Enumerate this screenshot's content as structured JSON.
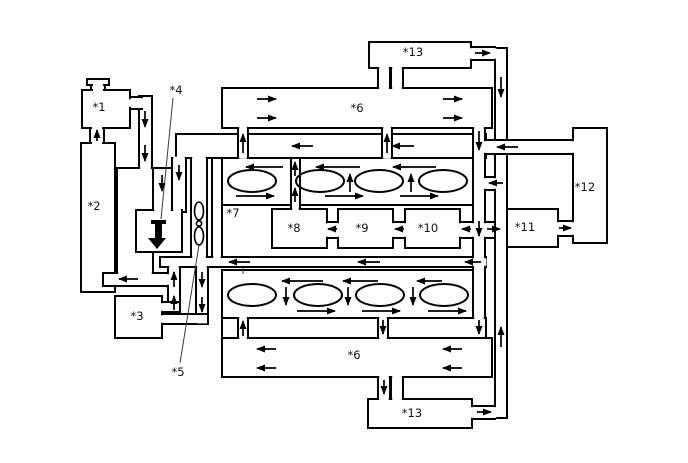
{
  "diagram": {
    "type": "engine-coolant-flow-schematic",
    "background_color": "#ffffff",
    "line_color": "#000000",
    "labels": {
      "c1": "*1",
      "c2": "*2",
      "c3": "*3",
      "c4": "*4",
      "c5": "*5",
      "c6": "*6",
      "c7": "*7",
      "c8": "*8",
      "c9": "*9",
      "c10": "*10",
      "c11": "*11",
      "c12": "*12",
      "c13": "*13"
    },
    "icons": {
      "thermostat": "thick-down-arrow-icon",
      "pump": "impeller-icon",
      "cap": "filler-cap-icon"
    },
    "flow_arrows": [
      [
        97,
        141,
        97,
        130
      ],
      [
        145,
        111,
        145,
        127
      ],
      [
        145,
        145,
        145,
        161
      ],
      [
        162,
        175,
        162,
        191
      ],
      [
        179,
        165,
        179,
        180
      ],
      [
        138,
        279,
        119,
        279
      ],
      [
        174,
        287,
        174,
        272
      ],
      [
        174,
        310,
        174,
        296
      ],
      [
        202,
        272,
        202,
        287
      ],
      [
        202,
        297,
        202,
        312
      ],
      [
        250,
        262,
        229,
        262
      ],
      [
        380,
        262,
        358,
        262
      ],
      [
        481,
        262,
        465,
        262
      ],
      [
        313,
        146,
        292,
        146
      ],
      [
        414,
        146,
        392,
        146
      ],
      [
        243,
        153,
        243,
        134
      ],
      [
        387,
        153,
        387,
        134
      ],
      [
        479,
        131,
        479,
        150
      ],
      [
        257,
        99,
        276,
        99
      ],
      [
        257,
        118,
        276,
        118
      ],
      [
        443,
        99,
        462,
        99
      ],
      [
        443,
        118,
        462,
        118
      ],
      [
        283,
        167,
        246,
        167
      ],
      [
        360,
        167,
        316,
        167
      ],
      [
        436,
        167,
        393,
        167
      ],
      [
        236,
        196,
        274,
        196
      ],
      [
        325,
        196,
        363,
        196
      ],
      [
        400,
        196,
        438,
        196
      ],
      [
        295,
        202,
        295,
        188
      ],
      [
        295,
        176,
        295,
        162
      ],
      [
        350,
        192,
        350,
        174
      ],
      [
        411,
        192,
        411,
        174
      ],
      [
        337,
        229,
        328,
        229
      ],
      [
        404,
        229,
        395,
        229
      ],
      [
        471,
        229,
        462,
        229
      ],
      [
        479,
        221,
        479,
        236
      ],
      [
        487,
        229,
        500,
        229
      ],
      [
        559,
        228,
        571,
        228
      ],
      [
        518,
        147,
        497,
        147
      ],
      [
        503,
        183,
        489,
        183
      ],
      [
        501,
        77,
        501,
        97
      ],
      [
        501,
        347,
        501,
        327
      ],
      [
        475,
        53,
        490,
        53
      ],
      [
        477,
        412,
        491,
        412
      ],
      [
        384,
        380,
        384,
        394
      ],
      [
        243,
        336,
        243,
        321
      ],
      [
        383,
        320,
        383,
        334
      ],
      [
        479,
        320,
        479,
        334
      ],
      [
        323,
        281,
        282,
        281
      ],
      [
        378,
        281,
        343,
        281
      ],
      [
        442,
        281,
        417,
        281
      ],
      [
        286,
        287,
        286,
        305
      ],
      [
        348,
        287,
        348,
        305
      ],
      [
        413,
        287,
        413,
        305
      ],
      [
        297,
        311,
        335,
        311
      ],
      [
        362,
        311,
        400,
        311
      ],
      [
        428,
        311,
        466,
        311
      ],
      [
        276,
        349,
        257,
        349
      ],
      [
        276,
        368,
        257,
        368
      ],
      [
        462,
        349,
        443,
        349
      ],
      [
        462,
        368,
        443,
        368
      ]
    ]
  }
}
